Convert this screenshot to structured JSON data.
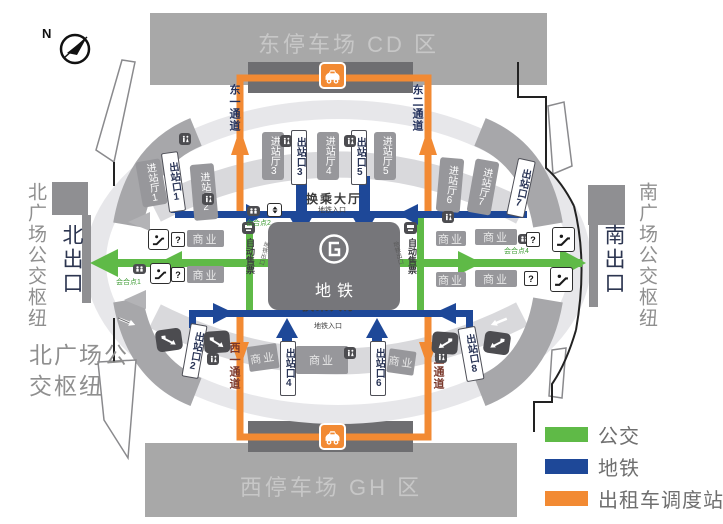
{
  "compass": {
    "north": "N"
  },
  "banners": {
    "east": "东停车场 CD 区",
    "west": "西停车场 GH 区"
  },
  "sides": {
    "north_hub": "北广场公交枢纽",
    "north_exit": "北出口",
    "south_hub": "南广场公交枢纽",
    "south_exit": "南出口",
    "north_hub_caption1": "北广场公",
    "north_hub_caption2": "交枢纽"
  },
  "channels": {
    "east1": "东一通道",
    "east2": "东二通道",
    "west1": "西一通道",
    "west2": "西二通道"
  },
  "halls": {
    "h1": "进站厅1",
    "h2": "进站厅2",
    "h3": "进站厅3",
    "h4": "进站厅4",
    "h5": "进站厅5",
    "h6": "进站厅6",
    "h7": "进站厅7"
  },
  "exits": {
    "e1": "出站口1",
    "e2": "出站口2",
    "e3": "出站口3",
    "e4": "出站口4",
    "e5": "出站口5",
    "e6": "出站口6",
    "e7": "出站口7",
    "e8": "出站口8"
  },
  "transfer": {
    "hall": "换乘大厅",
    "metro_entrance": "地铁入口"
  },
  "metro": {
    "name": "地铁",
    "ticket": "自动售票",
    "metro_exit": "地铁出口"
  },
  "shop": {
    "label": "商业"
  },
  "meeting": {
    "p1": "会合点1",
    "p2": "会合点2",
    "p4": "会合点4"
  },
  "info": {
    "question": "?"
  },
  "legend": {
    "bus": {
      "label": "公交",
      "color": "#5fba47"
    },
    "metro": {
      "label": "地铁",
      "color": "#1e4898"
    },
    "taxi": {
      "label": "出租车调度站",
      "color": "#f28a33"
    }
  }
}
